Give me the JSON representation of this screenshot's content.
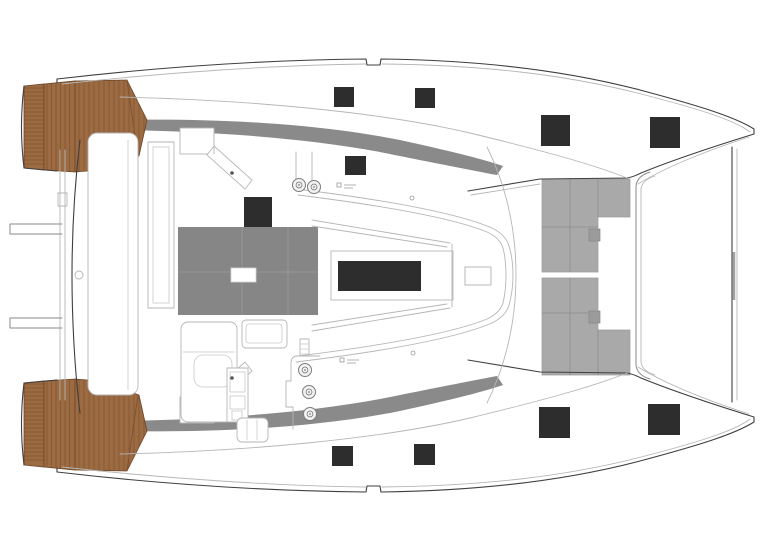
{
  "diagram": {
    "type": "boat-deck-plan",
    "description": "Catamaran deck plan, top view, bow to the right, twin hulls with teak aft platforms, foredeck trampoline and coachroof hatches",
    "orientation": "bow-right"
  },
  "colors": {
    "background": "#ffffff",
    "outline_dark": "#3f3f3f",
    "outline_mid": "#8a8a8a",
    "outline_light": "#b6b6b6",
    "teak": "#9c6b42",
    "teak_line": "#7f5333",
    "teak_edge": "#6e4426",
    "hatch_dark": "#2d2d2d",
    "gray_band": "#8a8a8a",
    "bimini_gray": "#868686",
    "bimini_grid": "#9a9a9a",
    "trampoline_gray": "#a9a9a9",
    "trampoline_grid": "#8f8f8f",
    "trampoline_step": "#9b9b9b",
    "winch_ring": "#7d7d7d",
    "winch_fill": "#f2f2f2",
    "white_hatch_stroke": "#d5d5d5"
  },
  "elements": {
    "deck_hatches": [
      {
        "name": "hatch-port-aft-1",
        "x": 334,
        "y": 87,
        "w": 20,
        "h": 20
      },
      {
        "name": "hatch-port-aft-2",
        "x": 415,
        "y": 88,
        "w": 20,
        "h": 20
      },
      {
        "name": "hatch-port-bow-1",
        "x": 541,
        "y": 115,
        "w": 29,
        "h": 31
      },
      {
        "name": "hatch-port-bow-2",
        "x": 650,
        "y": 117,
        "w": 30,
        "h": 31
      },
      {
        "name": "hatch-coachroof-small",
        "x": 345,
        "y": 156,
        "w": 21,
        "h": 19
      },
      {
        "name": "hatch-cockpit-roof",
        "x": 244,
        "y": 197,
        "w": 28,
        "h": 30
      },
      {
        "name": "hatch-stbd-aft-1",
        "x": 332,
        "y": 446,
        "w": 21,
        "h": 20
      },
      {
        "name": "hatch-stbd-aft-2",
        "x": 414,
        "y": 444,
        "w": 21,
        "h": 21
      },
      {
        "name": "hatch-stbd-bow-1",
        "x": 539,
        "y": 407,
        "w": 31,
        "h": 31
      },
      {
        "name": "hatch-stbd-bow-2",
        "x": 648,
        "y": 404,
        "w": 32,
        "h": 31
      }
    ],
    "skylight": {
      "x": 338,
      "y": 261,
      "w": 83,
      "h": 30
    },
    "mast_step": {
      "x": 465,
      "y": 267,
      "w": 26,
      "h": 18
    },
    "winches": [
      {
        "cx": 305,
        "cy": 370,
        "r": 6.5
      },
      {
        "cx": 309,
        "cy": 392,
        "r": 6.5
      },
      {
        "cx": 310,
        "cy": 414,
        "r": 6.5
      }
    ],
    "roof_winches": [
      {
        "cx": 299,
        "cy": 185,
        "r": 6.5
      },
      {
        "cx": 314,
        "cy": 187,
        "r": 6.5
      }
    ],
    "bimini": {
      "x": 178,
      "y": 227,
      "w": 140,
      "h": 88,
      "grid": [
        {
          "x1": 242,
          "y1": 227,
          "x2": 242,
          "y2": 315
        },
        {
          "x1": 288,
          "y1": 227,
          "x2": 288,
          "y2": 315
        },
        {
          "x1": 178,
          "y1": 272,
          "x2": 318,
          "y2": 272
        }
      ],
      "white_hatch": {
        "x": 231,
        "y": 268,
        "w": 25,
        "h": 14
      }
    },
    "trampoline": {
      "panels": [
        {
          "points": "542,179 630,179 630,217 598,217 598,272 542,272"
        },
        {
          "points": "542,278 598,278 598,330 630,330 630,375 542,375"
        }
      ],
      "grid": [
        {
          "x1": 570,
          "y1": 179,
          "x2": 570,
          "y2": 272
        },
        {
          "x1": 570,
          "y1": 278,
          "x2": 570,
          "y2": 375
        },
        {
          "x1": 542,
          "y1": 227,
          "x2": 598,
          "y2": 227
        },
        {
          "x1": 542,
          "y1": 313,
          "x2": 598,
          "y2": 313
        },
        {
          "x1": 598,
          "y1": 179,
          "x2": 598,
          "y2": 217
        },
        {
          "x1": 598,
          "y1": 330,
          "x2": 598,
          "y2": 375
        }
      ],
      "steps": [
        {
          "x": 589,
          "y": 229,
          "w": 11,
          "h": 12
        },
        {
          "x": 589,
          "y": 311,
          "w": 11,
          "h": 12
        }
      ]
    },
    "teak_panels": [
      {
        "points": "24,86 44,84 44,170 24,168",
        "orient": "h",
        "start": 88,
        "end": 167,
        "step": 4,
        "lo": 24,
        "hi": 44
      },
      {
        "points": "44,84 75,81 75,172 44,170",
        "orient": "v",
        "start": 47,
        "end": 73,
        "step": 4.5,
        "lo": 81,
        "hi": 172
      },
      {
        "points": "75,81 127,80 147,120 139,156 100,170 75,172",
        "orient": "v",
        "start": 79,
        "end": 145,
        "step": 5,
        "lo": 80,
        "hi": 172
      },
      {
        "points": "24,465 44,467 44,381 24,383",
        "orient": "h",
        "start": 384,
        "end": 463,
        "step": 4,
        "lo": 24,
        "hi": 44
      },
      {
        "points": "44,467 75,470 75,379 44,381",
        "orient": "v",
        "start": 47,
        "end": 73,
        "step": 4.5,
        "lo": 379,
        "hi": 470
      },
      {
        "points": "75,470 127,471 147,431 139,395 100,381 75,379",
        "orient": "v",
        "start": 79,
        "end": 145,
        "step": 5,
        "lo": 379,
        "hi": 471
      }
    ],
    "teak_dividers": [
      {
        "x1": 127,
        "y1": 81,
        "x2": 138,
        "y2": 156
      },
      {
        "x1": 127,
        "y1": 470,
        "x2": 138,
        "y2": 395
      }
    ]
  }
}
